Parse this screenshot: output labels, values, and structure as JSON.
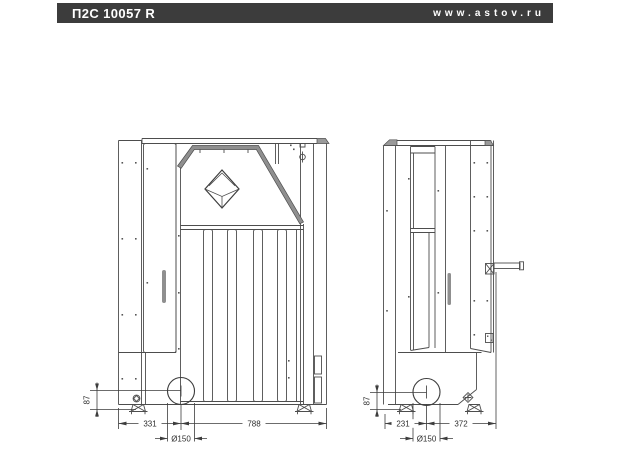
{
  "header": {
    "title": "П2С 10057 R",
    "website": "www.astov.ru"
  },
  "front_view": {
    "dim_left": "331",
    "dim_right": "788",
    "dim_diameter": "Ø150",
    "dim_height": "87"
  },
  "side_view": {
    "dim_left": "231",
    "dim_right": "372",
    "dim_diameter": "Ø150",
    "dim_height": "87"
  },
  "colors": {
    "header_bar": "#3c3c3c",
    "line": "#4d4d4d",
    "metal_fill": "#8f8f8f"
  }
}
